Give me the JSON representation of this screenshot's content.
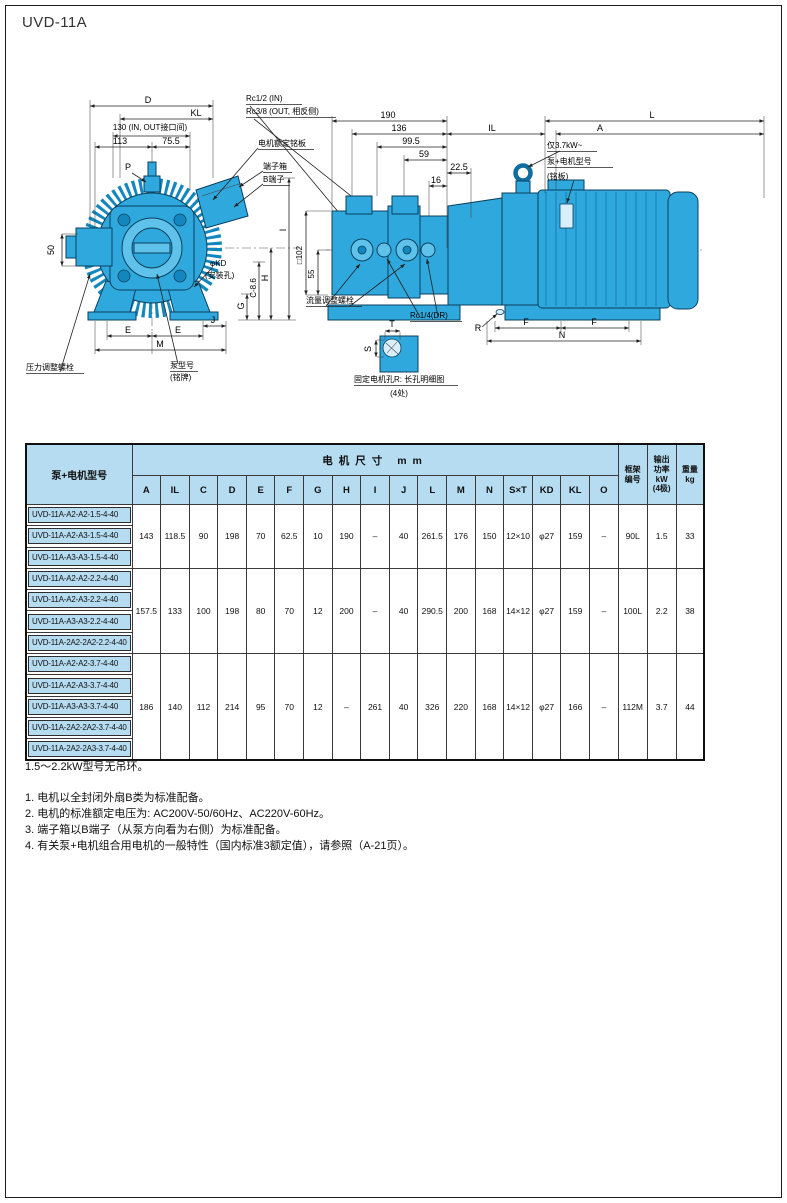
{
  "page": {
    "title": "UVD-11A"
  },
  "front_view": {
    "dim_d": "D",
    "dim_kl": "KL",
    "dim_port_span": "130 (IN, OUT接口间)",
    "dim_113": "113",
    "dim_75_5": "75.5",
    "label_p": "P",
    "dim_50": "50",
    "label_rc12_in": "Rc1/2 (IN)",
    "label_rc38_out": "Rc3/8 (OUT, 相反侧)",
    "label_motor_nameplate": "电机额定铭板",
    "label_terminal_box": "端子箱",
    "label_b_terminal": "B端子",
    "dim_e_left": "E",
    "dim_e_right": "E",
    "dim_j": "J",
    "dim_m": "M",
    "dim_g": "G",
    "dim_c": "C-8.6",
    "dim_h": "H",
    "dim_i": "I",
    "label_kd": "φKD",
    "label_kd_sub": "(安装孔)",
    "label_pressure_bolt": "压力调整螺栓",
    "label_pump_model": "泵型号",
    "label_pump_model_sub": "(铭牌)"
  },
  "side_view": {
    "dim_190": "190",
    "dim_136": "136",
    "dim_99_5": "99.5",
    "dim_59": "59",
    "dim_22_5": "22.5",
    "dim_16": "16",
    "dim_il": "IL",
    "dim_l": "L",
    "dim_a": "A",
    "label_eye": "仅3.7kW~",
    "label_unit_model": "泵+电机型号",
    "label_unit_model_sub": "(铭板)",
    "dim_sq102": "□102",
    "dim_55": "55",
    "label_flow_bolt": "流量调整螺栓",
    "label_rc14_dr": "Rc1/4(DR)",
    "dim_r": "R",
    "dim_f_left": "F",
    "dim_f_right": "F",
    "dim_n": "N",
    "detail_t": "T",
    "detail_s": "S",
    "detail_caption": "固定电机孔R: 长孔明细图",
    "detail_caption_sub": "(4处)"
  },
  "table": {
    "col_model": "泵+电机型号",
    "col_group": "电机尺寸 mm",
    "dim_cols": [
      "A",
      "IL",
      "C",
      "D",
      "E",
      "F",
      "G",
      "H",
      "I",
      "J",
      "L",
      "M",
      "N",
      "S×T",
      "KD",
      "KL",
      "O"
    ],
    "col_frame": "框架\n编号",
    "col_power": "输出\n功率\nkW\n(4极)",
    "col_weight": "重量\nkg",
    "groups": [
      {
        "models": [
          "UVD-11A-A2-A2-1.5-4-40",
          "UVD-11A-A2-A3-1.5-4-40",
          "UVD-11A-A3-A3-1.5-4-40"
        ],
        "values": [
          "143",
          "118.5",
          "90",
          "198",
          "70",
          "62.5",
          "10",
          "190",
          "–",
          "40",
          "261.5",
          "176",
          "150",
          "12×10",
          "φ27",
          "159",
          "–"
        ],
        "frame": "90L",
        "power": "1.5",
        "weight": "33"
      },
      {
        "models": [
          "UVD-11A-A2-A2-2.2-4-40",
          "UVD-11A-A2-A3-2.2-4-40",
          "UVD-11A-A3-A3-2.2-4-40",
          "UVD-11A-2A2-2A2-2.2-4-40"
        ],
        "values": [
          "157.5",
          "133",
          "100",
          "198",
          "80",
          "70",
          "12",
          "200",
          "–",
          "40",
          "290.5",
          "200",
          "168",
          "14×12",
          "φ27",
          "159",
          "–"
        ],
        "frame": "100L",
        "power": "2.2",
        "weight": "38"
      },
      {
        "models": [
          "UVD-11A-A2-A2-3.7-4-40",
          "UVD-11A-A2-A3-3.7-4-40",
          "UVD-11A-A3-A3-3.7-4-40",
          "UVD-11A-2A2-2A2-3.7-4-40",
          "UVD-11A-2A2-2A3-3.7-4-40"
        ],
        "values": [
          "186",
          "140",
          "112",
          "214",
          "95",
          "70",
          "12",
          "–",
          "261",
          "40",
          "326",
          "220",
          "168",
          "14×12",
          "φ27",
          "166",
          "–"
        ],
        "frame": "112M",
        "power": "3.7",
        "weight": "44"
      }
    ]
  },
  "notes": {
    "note0": "1.5～2.2kW型号无吊环。",
    "note1": "1. 电机以全封闭外扇B类为标准配备。",
    "note2": "2. 电机的标准额定电压为: AC200V-50/60Hz、AC220V-60Hz。",
    "note3": "3. 端子箱以B端子（从泵方向看为右侧）为标准配备。",
    "note4": "4. 有关泵+电机组合用电机的一般特性（国内标准3额定值），请参照（A-21页）。"
  }
}
